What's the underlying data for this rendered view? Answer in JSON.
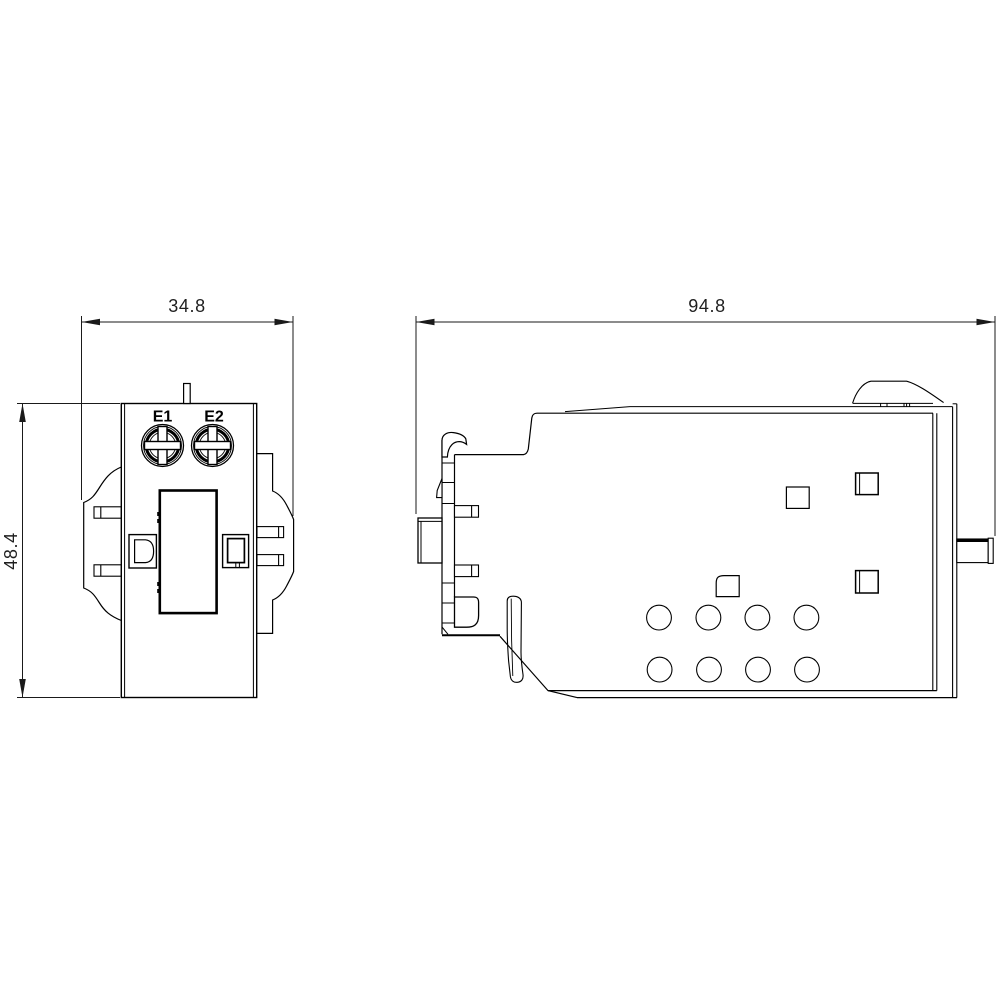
{
  "colors": {
    "background": "#ffffff",
    "line": "#000000",
    "dimension_text": "#1f1f1f"
  },
  "front_view": {
    "terminals": [
      {
        "label": "E1"
      },
      {
        "label": "E2"
      }
    ],
    "width_dimension": "34.8",
    "height_dimension": "48.4"
  },
  "side_view": {
    "width_dimension": "94.8"
  }
}
